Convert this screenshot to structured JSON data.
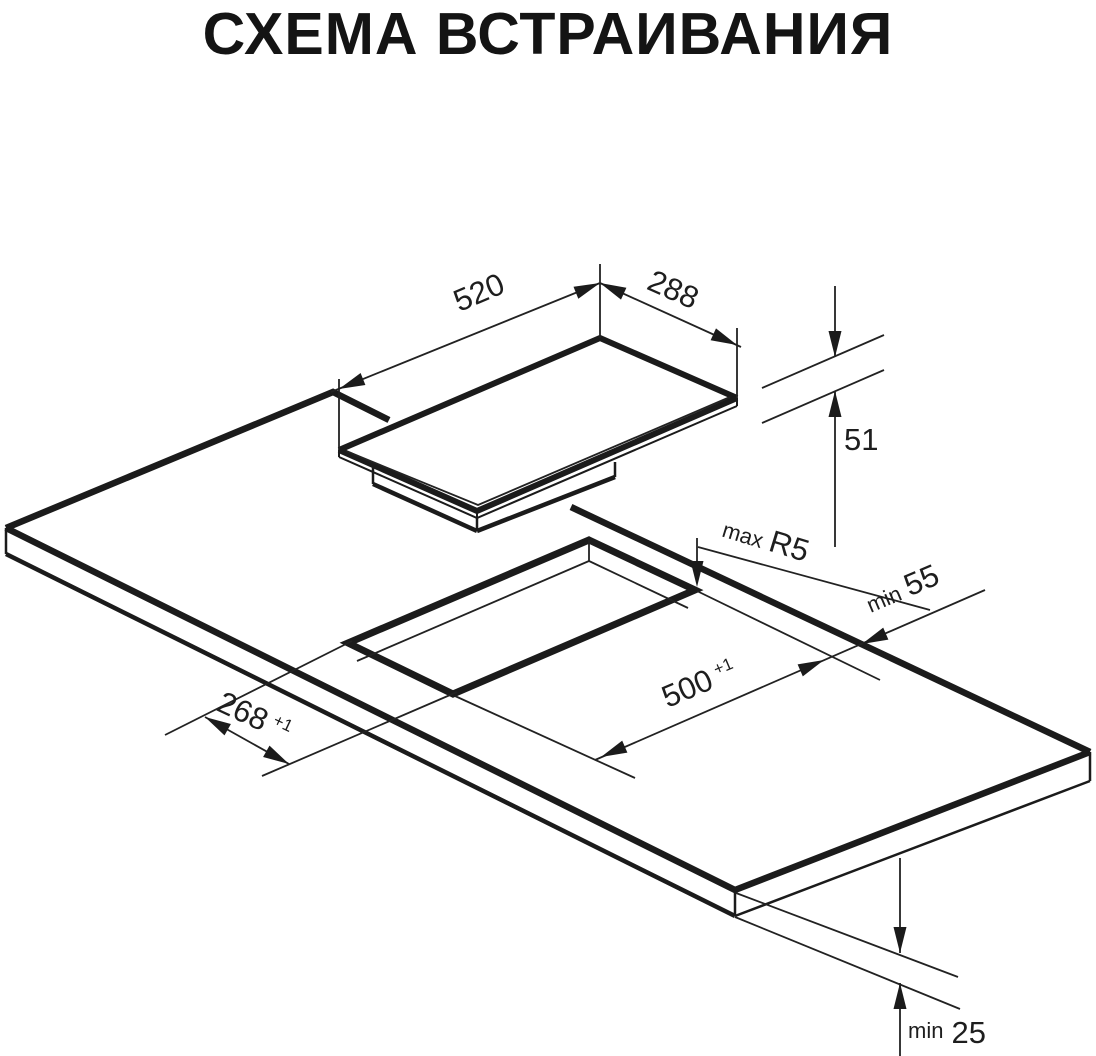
{
  "page": {
    "title": "СХЕМА ВСТРАИВАНИЯ"
  },
  "diagram": {
    "dimensions": {
      "hob_width": {
        "value": "520"
      },
      "hob_depth": {
        "value": "288"
      },
      "hob_height": {
        "value": "51"
      },
      "cutout_corner_radius": {
        "prefix": "max",
        "value": "R5"
      },
      "rear_clearance": {
        "prefix": "min",
        "value": "55"
      },
      "cutout_length": {
        "value": "500",
        "tolerance": "+1"
      },
      "cutout_width": {
        "value": "268",
        "tolerance": "+1"
      },
      "worktop_thickness": {
        "prefix": "min",
        "value": "25"
      }
    }
  }
}
